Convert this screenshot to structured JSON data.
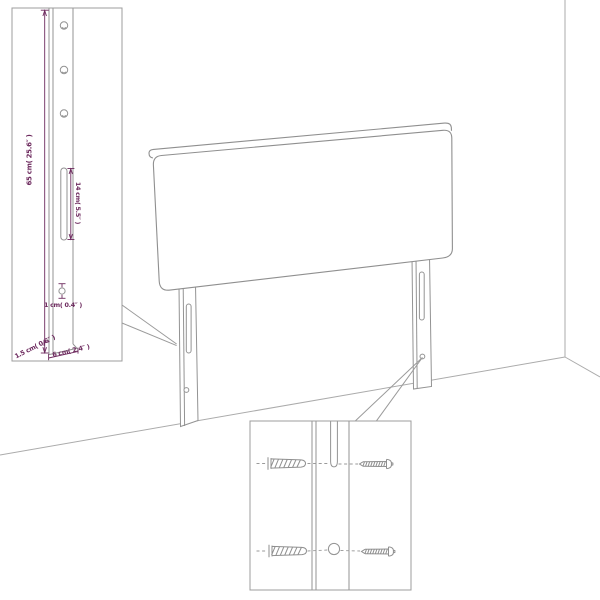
{
  "figure": {
    "kind": "headboard-assembly-diagram",
    "legs_visible": 2,
    "leg_top_holes_in_inset": 3,
    "wall_plugs_in_mount_inset": 2,
    "screws_in_mount_inset": 2
  },
  "labels": {
    "total_height": "65 cm( 25.6″ )",
    "slot_length": "14 cm( 5.5″ )",
    "hole_diameter": "1 cm( 0.4″ )",
    "side_thickness": "1.5 cm( 0.6″ )",
    "leg_width": "6 cm( 2.4″ )"
  },
  "colors": {
    "annotation": "#6d2a5e",
    "line_art": "#989898",
    "room_lines": "#ababab",
    "background": "#ffffff"
  },
  "icons": {
    "wall_plug": "wall-plug-icon",
    "screw": "screw-icon",
    "slot": "keyhole-slot-icon",
    "hole": "screw-hole-icon"
  }
}
